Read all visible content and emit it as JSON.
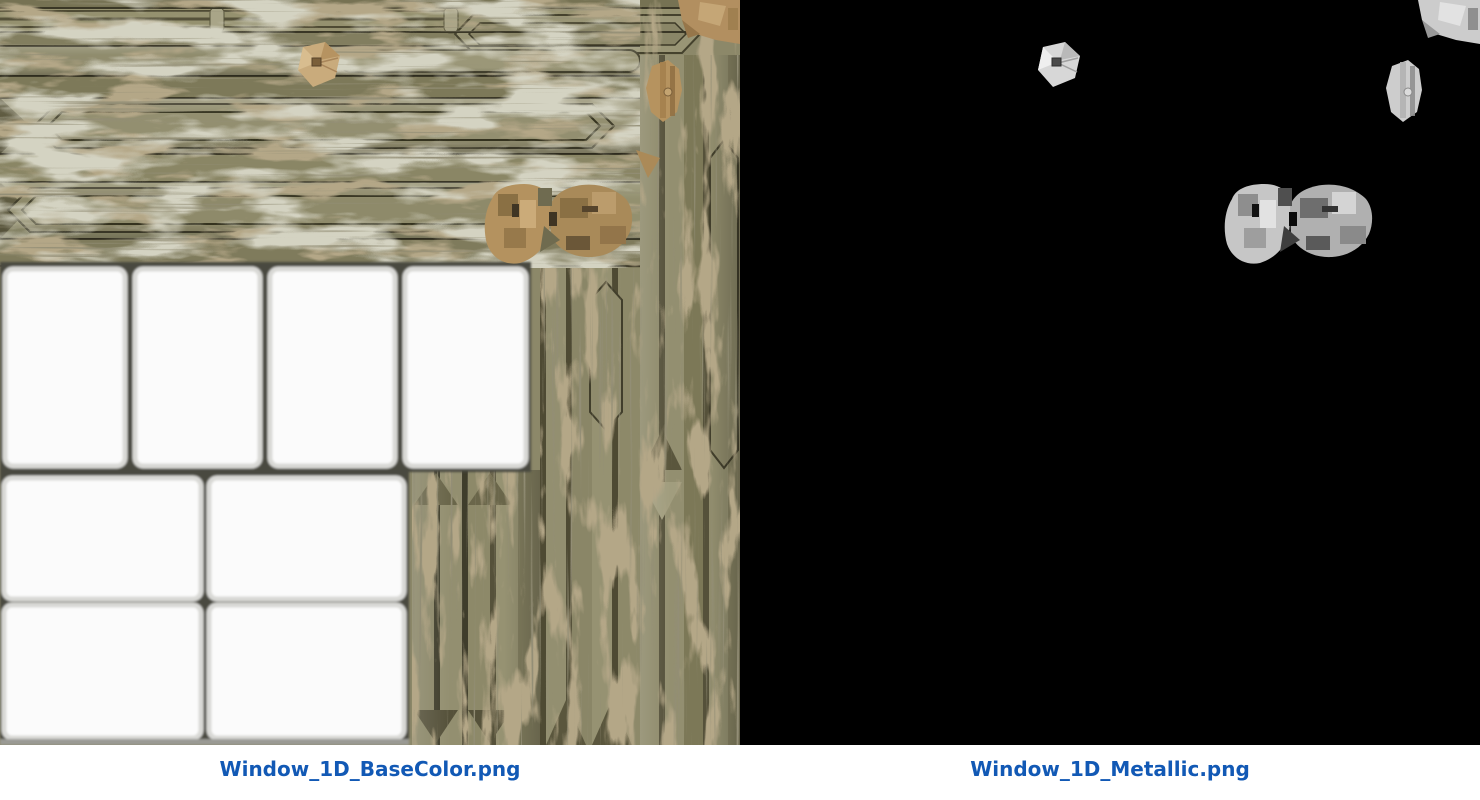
{
  "panels": [
    {
      "id": "basecolor",
      "caption": "Window_1D_BaseColor.png"
    },
    {
      "id": "metallic",
      "caption": "Window_1D_Metallic.png"
    }
  ],
  "colors": {
    "caption_text": "#1259b5",
    "caption_bar_bg": "#ffffff",
    "metallic_bg": "#000000",
    "basecolor_olive": "#8c8869",
    "basecolor_grunge_brown": "#74623e",
    "basecolor_metal_tan": "#b4925f",
    "pane_white": "#fbfbfb",
    "grout_dark": "#4a4840",
    "metallic_island_gray": "#c6c6c6"
  }
}
